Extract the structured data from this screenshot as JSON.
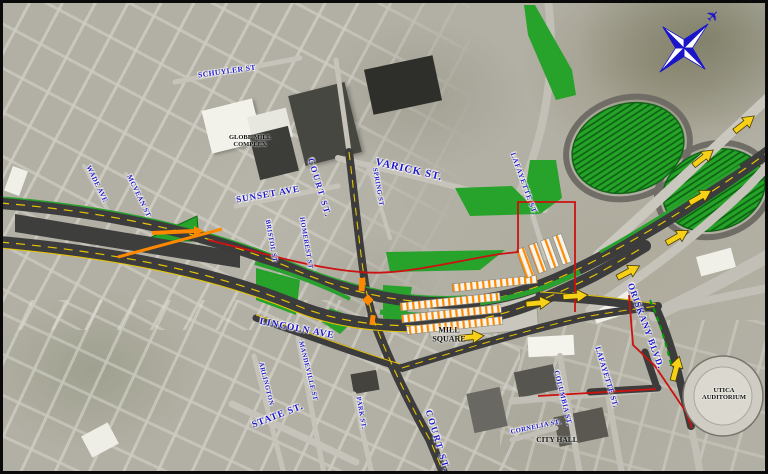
{
  "map": {
    "street_labels": [
      {
        "id": "schuyler-st",
        "text": "SCHUYLER ST",
        "x": 227,
        "y": 71,
        "rot": -8,
        "size": 7.5,
        "ls": 0.5
      },
      {
        "id": "court-st-upper",
        "text": "COURT ST.",
        "x": 320,
        "y": 188,
        "rot": 73,
        "size": 8.5,
        "ls": 2
      },
      {
        "id": "varick-st",
        "text": "VARICK ST.",
        "x": 409,
        "y": 170,
        "rot": 13,
        "size": 10.5,
        "ls": 1
      },
      {
        "id": "spring-st",
        "text": "SPRING ST",
        "x": 378,
        "y": 187,
        "rot": 80,
        "size": 6.5,
        "ls": 0.5
      },
      {
        "id": "lafayette-st-upper",
        "text": "LAFAYETTE ST.",
        "x": 524,
        "y": 184,
        "rot": 70,
        "size": 7,
        "ls": 1
      },
      {
        "id": "sunset-ave",
        "text": "SUNSET AVE",
        "x": 268,
        "y": 194,
        "rot": -10,
        "size": 9,
        "ls": 1
      },
      {
        "id": "wade-ave",
        "text": "WADE AVE",
        "x": 97,
        "y": 184,
        "rot": 64,
        "size": 7,
        "ls": 0.5
      },
      {
        "id": "mcvean-st",
        "text": "MCVEAN ST",
        "x": 139,
        "y": 196,
        "rot": 64,
        "size": 7,
        "ls": 0.5
      },
      {
        "id": "bristol-st",
        "text": "BRISTOL ST",
        "x": 271,
        "y": 241,
        "rot": 80,
        "size": 6.5,
        "ls": 0.5
      },
      {
        "id": "homerest-st",
        "text": "HOMEREST ST",
        "x": 306,
        "y": 243,
        "rot": 80,
        "size": 6.5,
        "ls": 0.5
      },
      {
        "id": "lincoln-ave",
        "text": "LINCOLN AVE",
        "x": 297,
        "y": 329,
        "rot": 11,
        "size": 9.5,
        "ls": 1
      },
      {
        "id": "arlington-st",
        "text": "ARLINGTON",
        "x": 266,
        "y": 384,
        "rot": 76,
        "size": 6.5,
        "ls": 0.5
      },
      {
        "id": "mandeville-st",
        "text": "MANDEVILLE ST",
        "x": 308,
        "y": 371,
        "rot": 76,
        "size": 6.5,
        "ls": 0.5
      },
      {
        "id": "state-st",
        "text": "STATE ST.",
        "x": 278,
        "y": 416,
        "rot": -21,
        "size": 9.5,
        "ls": 1
      },
      {
        "id": "park-st",
        "text": "PARK ST.",
        "x": 361,
        "y": 413,
        "rot": 80,
        "size": 6.5,
        "ls": 0.5
      },
      {
        "id": "court-st-lower",
        "text": "COURT ST.",
        "x": 438,
        "y": 441,
        "rot": 73,
        "size": 9,
        "ls": 2
      },
      {
        "id": "oriskany-blvd",
        "text": "ORISKANY BLVD.",
        "x": 646,
        "y": 326,
        "rot": 70,
        "size": 9,
        "ls": 1
      },
      {
        "id": "lafayette-st-lower",
        "text": "LAFAYETTE ST.",
        "x": 607,
        "y": 377,
        "rot": 73,
        "size": 7.5,
        "ls": 0.5
      },
      {
        "id": "columbia-st",
        "text": "COLUMBIA ST.",
        "x": 563,
        "y": 398,
        "rot": 76,
        "size": 7,
        "ls": 0.5
      },
      {
        "id": "cornelia-st",
        "text": "CORNELIA ST.",
        "x": 536,
        "y": 427,
        "rot": -12,
        "size": 6.5,
        "ls": 0.5
      }
    ],
    "place_labels": [
      {
        "id": "globe-mill-complex",
        "lines": [
          "GLOBE MILL",
          "COMPLEX"
        ],
        "x": 250,
        "y": 141,
        "size": 6.5
      },
      {
        "id": "mill-square",
        "lines": [
          "MILL",
          "SQUARE"
        ],
        "x": 449,
        "y": 335,
        "size": 8
      },
      {
        "id": "city-hall",
        "lines": [
          "CITY HALL"
        ],
        "x": 557,
        "y": 440,
        "size": 7.5
      },
      {
        "id": "utica-auditorium",
        "lines": [
          "UTICA",
          "AUDITORIUM"
        ],
        "x": 724,
        "y": 394,
        "size": 6.5
      }
    ],
    "flow_arrows": [
      {
        "x": 700,
        "y": 197,
        "angle": -30
      },
      {
        "x": 677,
        "y": 237,
        "angle": -30
      },
      {
        "x": 628,
        "y": 272,
        "angle": -28
      },
      {
        "x": 575,
        "y": 296,
        "angle": -4
      },
      {
        "x": 538,
        "y": 303,
        "angle": -6
      },
      {
        "x": 471,
        "y": 337,
        "angle": -6
      },
      {
        "x": 676,
        "y": 369,
        "angle": -75
      },
      {
        "x": 703,
        "y": 158,
        "angle": -38
      },
      {
        "x": 744,
        "y": 124,
        "angle": -38
      }
    ],
    "icons": {
      "compass_rose": {
        "x": 684,
        "y": 48
      },
      "airplane": {
        "x": 714,
        "y": 17,
        "glyph": "✈",
        "rot": -45
      }
    },
    "colors": {
      "street_label_blue": "#1b14c9",
      "place_label_black": "#111111",
      "proposed_road": "#3c3c3c",
      "lane_line_yellow": "#e6c400",
      "median_green": "#2aa12e",
      "hatch_green": "#23a428",
      "parking_orange": "#ff8c00",
      "limit_line_red": "#cc1111",
      "arrow_yellow": "#f7d117",
      "compass_blue": "#1a15c9"
    }
  }
}
